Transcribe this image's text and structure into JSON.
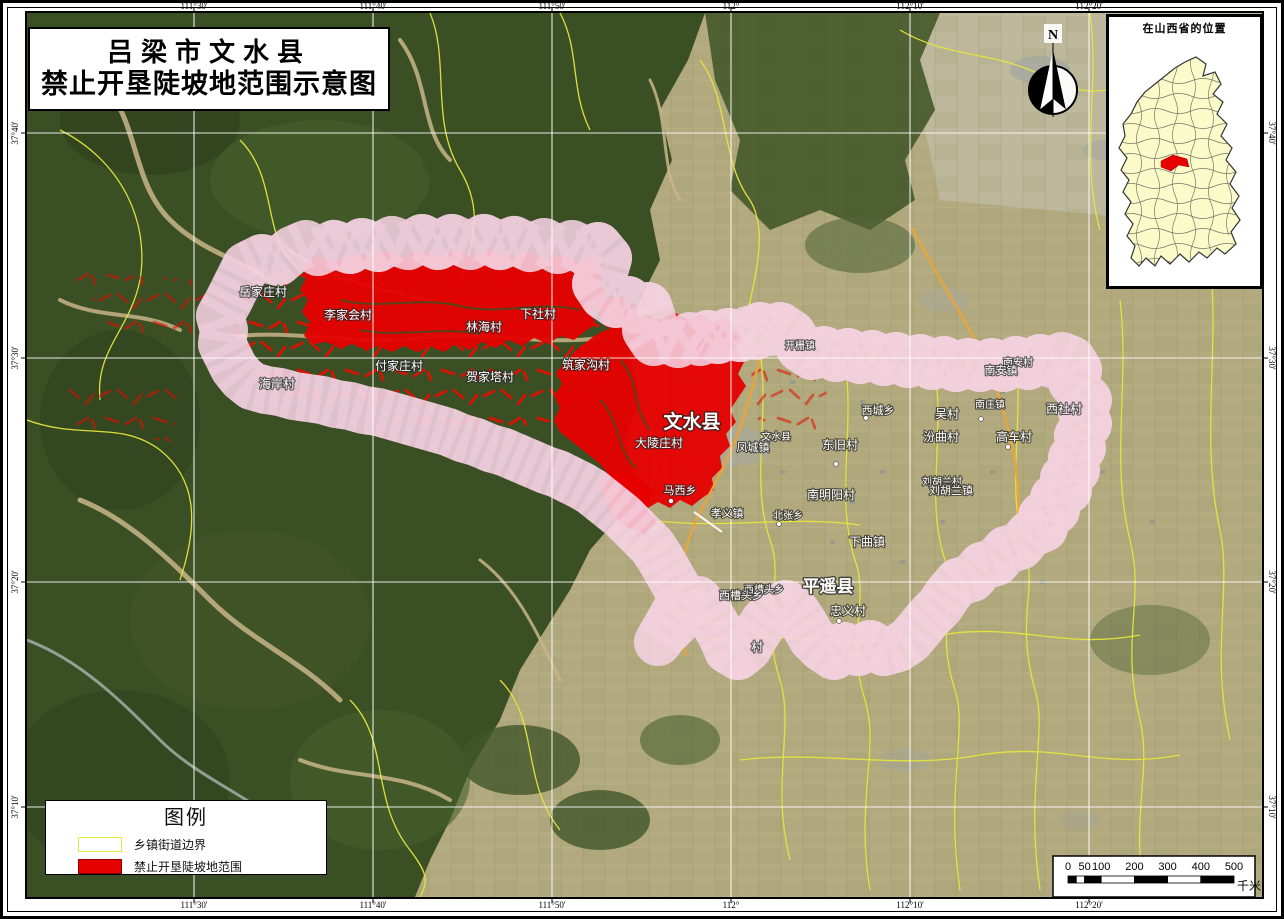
{
  "page": {
    "title_line1": "吕梁市文水县",
    "title_line2": "禁止开垦陡坡地范围示意图"
  },
  "inset": {
    "title": "在山西省的位置"
  },
  "legend": {
    "title": "图例",
    "items": [
      {
        "label": "乡镇街道边界"
      },
      {
        "label": "禁止开垦陡坡地范围"
      }
    ]
  },
  "scalebar": {
    "labels": [
      "0",
      "50",
      "100",
      "200",
      "300",
      "400",
      "500"
    ],
    "values": [
      0,
      50,
      100,
      200,
      300,
      400,
      500
    ],
    "unit": "千米"
  },
  "north": {
    "label": "N"
  },
  "grid": {
    "meridians": [
      {
        "label": "111°30'",
        "x": 194
      },
      {
        "label": "111°40'",
        "x": 373
      },
      {
        "label": "111°50'",
        "x": 552
      },
      {
        "label": "112°",
        "x": 731
      },
      {
        "label": "112°10'",
        "x": 910
      },
      {
        "label": "112°20'",
        "x": 1089
      }
    ],
    "parallels": [
      {
        "label": "37°40'",
        "y": 133
      },
      {
        "label": "37°30'",
        "y": 358
      },
      {
        "label": "37°20'",
        "y": 582
      },
      {
        "label": "37°10'",
        "y": 807
      }
    ]
  },
  "map": {
    "labels": [
      {
        "text": "岳家庄村",
        "x": 263,
        "y": 296,
        "size": 12
      },
      {
        "text": "李家会村",
        "x": 348,
        "y": 319,
        "size": 12
      },
      {
        "text": "林海村",
        "x": 484,
        "y": 331,
        "size": 12
      },
      {
        "text": "下社村",
        "x": 538,
        "y": 318,
        "size": 12
      },
      {
        "text": "海岸村",
        "x": 277,
        "y": 388,
        "size": 12
      },
      {
        "text": "付家庄村",
        "x": 399,
        "y": 370,
        "size": 12
      },
      {
        "text": "贺家塔村",
        "x": 490,
        "y": 381,
        "size": 12
      },
      {
        "text": "筑家沟村",
        "x": 586,
        "y": 369,
        "size": 12
      },
      {
        "text": "文水县",
        "x": 692,
        "y": 428,
        "size": 19,
        "bold": true
      },
      {
        "text": "大陵庄村",
        "x": 659,
        "y": 447,
        "size": 12
      },
      {
        "text": "文水县",
        "x": 776,
        "y": 440,
        "size": 10
      },
      {
        "text": "凤城镇",
        "x": 753,
        "y": 451,
        "size": 11
      },
      {
        "text": "开栅镇",
        "x": 800,
        "y": 349,
        "size": 10
      },
      {
        "text": "西城乡",
        "x": 878,
        "y": 414,
        "size": 11
      },
      {
        "text": "东旧村",
        "x": 840,
        "y": 449,
        "size": 12
      },
      {
        "text": "南庄镇",
        "x": 990,
        "y": 408,
        "size": 10
      },
      {
        "text": "南安村",
        "x": 1018,
        "y": 366,
        "size": 10
      },
      {
        "text": "南安镇",
        "x": 1001,
        "y": 374,
        "size": 11
      },
      {
        "text": "吴村",
        "x": 947,
        "y": 418,
        "size": 12
      },
      {
        "text": "西社村",
        "x": 1064,
        "y": 413,
        "size": 12
      },
      {
        "text": "汾曲村",
        "x": 941,
        "y": 441,
        "size": 12
      },
      {
        "text": "高车村",
        "x": 1014,
        "y": 441,
        "size": 12
      },
      {
        "text": "马西乡",
        "x": 680,
        "y": 494,
        "size": 11
      },
      {
        "text": "孝义镇",
        "x": 727,
        "y": 517,
        "size": 11
      },
      {
        "text": "北张乡",
        "x": 788,
        "y": 519,
        "size": 10
      },
      {
        "text": "南明阳村",
        "x": 831,
        "y": 499,
        "size": 12
      },
      {
        "text": "刘胡兰村",
        "x": 942,
        "y": 485,
        "size": 10
      },
      {
        "text": "刘胡兰镇",
        "x": 951,
        "y": 494,
        "size": 11
      },
      {
        "text": "下曲镇",
        "x": 867,
        "y": 546,
        "size": 12
      },
      {
        "text": "平遥县",
        "x": 828,
        "y": 592,
        "size": 17,
        "bold": true
      },
      {
        "text": "西槽头乡",
        "x": 764,
        "y": 593,
        "size": 10
      },
      {
        "text": "西槽头乡",
        "x": 741,
        "y": 599,
        "size": 11
      },
      {
        "text": "忠义村",
        "x": 848,
        "y": 615,
        "size": 12
      },
      {
        "text": "村",
        "x": 757,
        "y": 651,
        "size": 12
      }
    ],
    "dots": [
      [
        762,
        441
      ],
      [
        671,
        501
      ],
      [
        866,
        418
      ],
      [
        981,
        419
      ],
      [
        836,
        464
      ],
      [
        839,
        621
      ],
      [
        779,
        524
      ],
      [
        1008,
        447
      ],
      [
        820,
        582
      ]
    ]
  },
  "colors": {
    "prohibited_red": "#E60000",
    "buffer_pink": "#EFB3C6",
    "township_yellow": "#E6E63C",
    "boundary_cyan": "#3FE0D0",
    "province_fill": "#FBFBC9"
  }
}
